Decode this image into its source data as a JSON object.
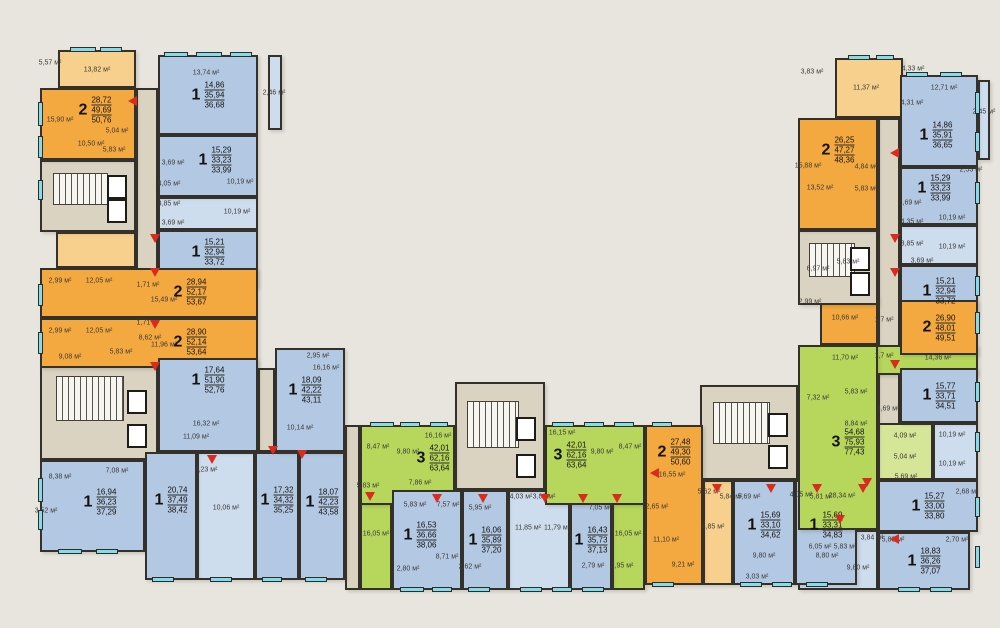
{
  "plan": {
    "width": 1000,
    "height": 628,
    "background": "#e8e5df",
    "palette": {
      "one_room": "#b3c8e2",
      "one_room_light": "#cdddee",
      "two_room": "#f3a93f",
      "two_room_light": "#f8d08d",
      "three_room": "#b6d75c",
      "three_room_light": "#d6e698",
      "common_area": "#dad3c1",
      "wall": "#34312b",
      "window": "#84dcea",
      "entrance_arrow": "#d92c1e"
    },
    "area_unit": "м²"
  },
  "apartments": [
    {
      "n": "2",
      "a": [
        "28,72",
        "49,69",
        "50,76"
      ],
      "c": "two",
      "r": [
        40,
        88,
        96,
        72
      ],
      "l": [
        95,
        110
      ]
    },
    {
      "n": "1",
      "a": [
        "14,86",
        "35,94",
        "36,68"
      ],
      "c": "one",
      "r": [
        158,
        55,
        100,
        80
      ],
      "l": [
        208,
        95
      ]
    },
    {
      "n": "1",
      "a": [
        "15,29",
        "33,23",
        "33,99"
      ],
      "c": "one",
      "r": [
        158,
        135,
        100,
        62
      ],
      "l": [
        215,
        160
      ]
    },
    {
      "n": "1",
      "a": [
        "15,21",
        "32,94",
        "33,72"
      ],
      "c": "one",
      "r": [
        158,
        230,
        100,
        58
      ],
      "l": [
        208,
        252
      ]
    },
    {
      "n": "2",
      "a": [
        "28,94",
        "52,17",
        "53,67"
      ],
      "c": "two",
      "r": [
        40,
        268,
        218,
        50
      ],
      "l": [
        190,
        292
      ]
    },
    {
      "n": "2",
      "a": [
        "28,90",
        "52,14",
        "53,64"
      ],
      "c": "two",
      "r": [
        40,
        318,
        218,
        50
      ],
      "l": [
        190,
        342
      ]
    },
    {
      "n": "1",
      "a": [
        "17,64",
        "51,90",
        "52,76"
      ],
      "c": "one",
      "r": [
        158,
        358,
        100,
        94
      ],
      "l": [
        208,
        380
      ]
    },
    {
      "n": "1",
      "a": [
        "16,94",
        "36,23",
        "37,29"
      ],
      "c": "one",
      "r": [
        40,
        460,
        105,
        92
      ],
      "l": [
        100,
        502
      ]
    },
    {
      "n": "1",
      "a": [
        "20,74",
        "37,49",
        "38,42"
      ],
      "c": "one",
      "r": [
        145,
        452,
        52,
        128
      ],
      "l": [
        171,
        500
      ]
    },
    {
      "n": "1",
      "a": [
        "17,32",
        "34,32",
        "35,25"
      ],
      "c": "one",
      "r": [
        255,
        452,
        44,
        128
      ],
      "l": [
        277,
        500
      ]
    },
    {
      "n": "1",
      "a": [
        "18,07",
        "42,23",
        "43,58"
      ],
      "c": "one",
      "r": [
        299,
        452,
        46,
        128
      ],
      "l": [
        322,
        502
      ]
    },
    {
      "n": "1",
      "a": [
        "18,09",
        "42,22",
        "43,11"
      ],
      "c": "one",
      "r": [
        275,
        348,
        70,
        104
      ],
      "l": [
        305,
        390
      ]
    },
    {
      "n": "3",
      "a": [
        "42,01",
        "62,16",
        "63,64"
      ],
      "c": "three",
      "r": [
        360,
        425,
        95,
        80
      ],
      "l": [
        433,
        458
      ]
    },
    {
      "n": "1",
      "a": [
        "16,53",
        "36,66",
        "38,06"
      ],
      "c": "one",
      "r": [
        392,
        490,
        70,
        100
      ],
      "l": [
        420,
        535
      ]
    },
    {
      "n": "1",
      "a": [
        "16,06",
        "35,89",
        "37,20"
      ],
      "c": "one",
      "r": [
        462,
        490,
        46,
        100
      ],
      "l": [
        485,
        540
      ]
    },
    {
      "n": "1",
      "a": [
        "16,43",
        "35,73",
        "37,13"
      ],
      "c": "one",
      "r": [
        570,
        490,
        42,
        100
      ],
      "l": [
        591,
        540
      ]
    },
    {
      "n": "3",
      "a": [
        "42,01",
        "62,16",
        "63,64"
      ],
      "c": "three",
      "r": [
        545,
        425,
        100,
        80
      ],
      "l": [
        570,
        455
      ]
    },
    {
      "n": "2",
      "a": [
        "27,48",
        "49,30",
        "50,60"
      ],
      "c": "two",
      "r": [
        645,
        425,
        58,
        160
      ],
      "l": [
        674,
        452
      ]
    },
    {
      "n": "1",
      "a": [
        "15,69",
        "33,10",
        "34,62"
      ],
      "c": "one",
      "r": [
        733,
        480,
        62,
        105
      ],
      "l": [
        764,
        525
      ]
    },
    {
      "n": "1",
      "a": [
        "15,69",
        "33,31",
        "34,83"
      ],
      "c": "one",
      "r": [
        795,
        480,
        62,
        105
      ],
      "l": [
        826,
        525
      ]
    },
    {
      "n": "2",
      "a": [
        "26,25",
        "47,27",
        "48,36"
      ],
      "c": "two",
      "r": [
        798,
        118,
        80,
        112
      ],
      "l": [
        838,
        150
      ]
    },
    {
      "n": "1",
      "a": [
        "14,86",
        "35,91",
        "36,65"
      ],
      "c": "one",
      "r": [
        900,
        75,
        78,
        92
      ],
      "l": [
        936,
        135
      ]
    },
    {
      "n": "1",
      "a": [
        "15,29",
        "33,23",
        "33,99"
      ],
      "c": "one",
      "r": [
        900,
        167,
        78,
        58
      ],
      "l": [
        934,
        188
      ]
    },
    {
      "n": "1",
      "a": [
        "15,21",
        "32,94",
        "33,72"
      ],
      "c": "one",
      "r": [
        900,
        265,
        78,
        52
      ]
    },
    {
      "n": "2",
      "a": [
        "26,90",
        "48,01",
        "49,51"
      ],
      "c": "two",
      "r": [
        900,
        300,
        78,
        55
      ]
    },
    {
      "n": "1",
      "a": [
        "15,77",
        "33,71",
        "34,51"
      ],
      "c": "one",
      "r": [
        900,
        368,
        78,
        55
      ]
    },
    {
      "n": "3",
      "a": [
        "54,68",
        "75,93",
        "77,43"
      ],
      "c": "three",
      "r": [
        798,
        345,
        80,
        185
      ],
      "l": [
        848,
        442
      ]
    },
    {
      "n": "1",
      "a": [
        "15,27",
        "33,00",
        "33,80"
      ],
      "c": "one",
      "r": [
        878,
        480,
        100,
        52
      ]
    },
    {
      "n": "1",
      "a": [
        "18,83",
        "36,26",
        "37,07"
      ],
      "c": "one",
      "r": [
        878,
        532,
        92,
        58
      ]
    }
  ],
  "zones": [
    {
      "c": "two_light",
      "r": [
        58,
        50,
        78,
        38
      ]
    },
    {
      "c": "two_light",
      "r": [
        56,
        232,
        80,
        36
      ]
    },
    {
      "c": "common",
      "r": [
        136,
        88,
        22,
        372
      ]
    },
    {
      "c": "one_light",
      "r": [
        158,
        197,
        100,
        33
      ]
    },
    {
      "c": "one_light",
      "r": [
        197,
        452,
        58,
        128
      ]
    },
    {
      "c": "common",
      "r": [
        345,
        425,
        15,
        165
      ]
    },
    {
      "c": "common",
      "r": [
        258,
        368,
        17,
        84
      ]
    },
    {
      "c": "three",
      "r": [
        360,
        500,
        32,
        90
      ]
    },
    {
      "c": "one_light",
      "r": [
        508,
        490,
        62,
        100
      ]
    },
    {
      "c": "three",
      "r": [
        612,
        500,
        33,
        90
      ]
    },
    {
      "c": "two_light",
      "r": [
        703,
        480,
        30,
        105
      ]
    },
    {
      "c": "one_light",
      "r": [
        857,
        480,
        21,
        105
      ]
    },
    {
      "c": "two_light",
      "r": [
        835,
        58,
        68,
        60
      ]
    },
    {
      "c": "common",
      "r": [
        878,
        118,
        22,
        362
      ]
    },
    {
      "c": "one_light",
      "r": [
        900,
        225,
        78,
        40
      ]
    },
    {
      "c": "two",
      "r": [
        820,
        295,
        58,
        50
      ]
    },
    {
      "c": "three",
      "r": [
        820,
        345,
        158,
        30
      ]
    },
    {
      "c": "three_light",
      "r": [
        878,
        423,
        55,
        57
      ]
    },
    {
      "c": "one_light",
      "r": [
        933,
        423,
        45,
        57
      ]
    },
    {
      "c": "one_light",
      "r": [
        798,
        530,
        80,
        60
      ]
    },
    {
      "c": "one_light",
      "r": [
        268,
        55,
        14,
        75
      ]
    },
    {
      "c": "one_light",
      "r": [
        978,
        80,
        12,
        80
      ]
    }
  ],
  "cores": [
    {
      "r": [
        40,
        160,
        96,
        72
      ]
    },
    {
      "r": [
        40,
        358,
        118,
        102
      ]
    },
    {
      "r": [
        455,
        382,
        90,
        108
      ]
    },
    {
      "r": [
        700,
        385,
        98,
        95
      ]
    },
    {
      "r": [
        798,
        230,
        80,
        75
      ]
    }
  ],
  "windows": [
    [
      70,
      47,
      26,
      5
    ],
    [
      100,
      47,
      22,
      5
    ],
    [
      164,
      52,
      24,
      5
    ],
    [
      196,
      52,
      26,
      5
    ],
    [
      230,
      52,
      22,
      5
    ],
    [
      848,
      55,
      22,
      5
    ],
    [
      876,
      55,
      18,
      5
    ],
    [
      906,
      72,
      22,
      5
    ],
    [
      940,
      72,
      22,
      5
    ],
    [
      38,
      102,
      5,
      24
    ],
    [
      38,
      136,
      5,
      22
    ],
    [
      38,
      180,
      5,
      20
    ],
    [
      38,
      284,
      5,
      22
    ],
    [
      38,
      332,
      5,
      22
    ],
    [
      38,
      478,
      5,
      24
    ],
    [
      38,
      510,
      5,
      20
    ],
    [
      975,
      92,
      5,
      22
    ],
    [
      975,
      132,
      5,
      20
    ],
    [
      975,
      182,
      5,
      22
    ],
    [
      975,
      276,
      5,
      20
    ],
    [
      975,
      312,
      5,
      22
    ],
    [
      975,
      382,
      5,
      20
    ],
    [
      975,
      432,
      5,
      20
    ],
    [
      975,
      497,
      5,
      20
    ],
    [
      975,
      546,
      5,
      22
    ],
    [
      58,
      549,
      24,
      5
    ],
    [
      96,
      549,
      22,
      5
    ],
    [
      152,
      577,
      22,
      5
    ],
    [
      210,
      577,
      22,
      5
    ],
    [
      262,
      577,
      20,
      5
    ],
    [
      305,
      577,
      22,
      5
    ],
    [
      400,
      587,
      24,
      5
    ],
    [
      432,
      587,
      20,
      5
    ],
    [
      468,
      587,
      22,
      5
    ],
    [
      520,
      587,
      22,
      5
    ],
    [
      552,
      587,
      20,
      5
    ],
    [
      582,
      587,
      22,
      5
    ],
    [
      652,
      582,
      22,
      5
    ],
    [
      740,
      582,
      22,
      5
    ],
    [
      772,
      582,
      20,
      5
    ],
    [
      806,
      582,
      22,
      5
    ],
    [
      898,
      587,
      22,
      5
    ],
    [
      930,
      587,
      22,
      5
    ],
    [
      370,
      422,
      24,
      5
    ],
    [
      400,
      422,
      20,
      5
    ],
    [
      430,
      422,
      18,
      5
    ],
    [
      552,
      422,
      22,
      5
    ],
    [
      584,
      422,
      20,
      5
    ],
    [
      614,
      422,
      20,
      5
    ],
    [
      652,
      422,
      20,
      5
    ]
  ],
  "arrows": [
    [
      128,
      96,
      "l"
    ],
    [
      150,
      234,
      "d"
    ],
    [
      150,
      268,
      "d"
    ],
    [
      150,
      320,
      "d"
    ],
    [
      150,
      362,
      "d"
    ],
    [
      207,
      455,
      "d"
    ],
    [
      268,
      446,
      "d"
    ],
    [
      297,
      450,
      "d"
    ],
    [
      365,
      492,
      "d"
    ],
    [
      432,
      494,
      "d"
    ],
    [
      478,
      494,
      "d"
    ],
    [
      540,
      494,
      "d"
    ],
    [
      578,
      494,
      "d"
    ],
    [
      612,
      494,
      "d"
    ],
    [
      650,
      468,
      "l"
    ],
    [
      712,
      484,
      "d"
    ],
    [
      766,
      484,
      "d"
    ],
    [
      812,
      484,
      "d"
    ],
    [
      858,
      484,
      "d"
    ],
    [
      890,
      148,
      "l"
    ],
    [
      890,
      234,
      "d"
    ],
    [
      890,
      268,
      "d"
    ],
    [
      890,
      360,
      "d"
    ],
    [
      862,
      478,
      "d"
    ],
    [
      835,
      515,
      "d"
    ],
    [
      890,
      534,
      "l"
    ]
  ],
  "rooms": [
    [
      "5,57 м²",
      50,
      63
    ],
    [
      "13,82 м²",
      97,
      70
    ],
    [
      "13,74 м²",
      206,
      73
    ],
    [
      "2,46 м²",
      274,
      93
    ],
    [
      "15,90 м²",
      60,
      120
    ],
    [
      "10,50 м²",
      91,
      144
    ],
    [
      "5,04 м²",
      117,
      131
    ],
    [
      "5,83 м²",
      114,
      150
    ],
    [
      "3,69 м²",
      173,
      163
    ],
    [
      "4,05 м²",
      169,
      184
    ],
    [
      "3,85 м²",
      169,
      204
    ],
    [
      "10,19 м²",
      240,
      182
    ],
    [
      "10,19 м²",
      237,
      212
    ],
    [
      "3,69 м²",
      173,
      223
    ],
    [
      "2,99 м²",
      60,
      281
    ],
    [
      "12,05 м²",
      99,
      281
    ],
    [
      "1,71 м²",
      148,
      285
    ],
    [
      "15,49 м²",
      164,
      300
    ],
    [
      "2,99 м²",
      60,
      331
    ],
    [
      "12,05 м²",
      99,
      331
    ],
    [
      "1,71 м²",
      148,
      323
    ],
    [
      "11,96 м²",
      164,
      345
    ],
    [
      "9,08 м²",
      70,
      357
    ],
    [
      "5,83 м²",
      121,
      352
    ],
    [
      "8,62 м²",
      150,
      338
    ],
    [
      "16,32 м²",
      206,
      424
    ],
    [
      "11,09 м²",
      196,
      437
    ],
    [
      "8,38 м²",
      60,
      477
    ],
    [
      "7,08 м²",
      117,
      471
    ],
    [
      "3,52 м²",
      46,
      511
    ],
    [
      "10,06 м²",
      226,
      508
    ],
    [
      "3,23 м²",
      206,
      470
    ],
    [
      "2,95 м²",
      318,
      356
    ],
    [
      "16,16 м²",
      326,
      368
    ],
    [
      "10,14 м²",
      300,
      428
    ],
    [
      "16,16 м²",
      438,
      436
    ],
    [
      "8,47 м²",
      378,
      447
    ],
    [
      "9,80 м²",
      408,
      452
    ],
    [
      "5,83 м²",
      368,
      486
    ],
    [
      "7,86 м²",
      420,
      483
    ],
    [
      "16,05 м²",
      376,
      534
    ],
    [
      "5,83 м²",
      415,
      505
    ],
    [
      "7,57 м²",
      448,
      505
    ],
    [
      "8,71 м²",
      447,
      557
    ],
    [
      "2,80 м²",
      408,
      569
    ],
    [
      "5,95 м²",
      480,
      508
    ],
    [
      "4,03 м²",
      521,
      497
    ],
    [
      "3,83 м²",
      544,
      497
    ],
    [
      "11,85 м²",
      528,
      528
    ],
    [
      "11,79 м²",
      557,
      528
    ],
    [
      "2,62 м²",
      470,
      567
    ],
    [
      "16,15 м²",
      562,
      433
    ],
    [
      "9,80 м²",
      602,
      452
    ],
    [
      "8,47 м²",
      630,
      447
    ],
    [
      "7,05 м²",
      600,
      508
    ],
    [
      "16,05 м²",
      628,
      534
    ],
    [
      "2,79 м²",
      593,
      566
    ],
    [
      "2,95 м²",
      622,
      566
    ],
    [
      "16,55 м²",
      672,
      475
    ],
    [
      "2,65 м²",
      657,
      507
    ],
    [
      "11,10 м²",
      666,
      540
    ],
    [
      "9,21 м²",
      683,
      565
    ],
    [
      "5,62 м²",
      709,
      492
    ],
    [
      "4,85 м²",
      713,
      527
    ],
    [
      "5,84 м²",
      731,
      497
    ],
    [
      "5,69 м²",
      749,
      497
    ],
    [
      "9,80 м²",
      764,
      556
    ],
    [
      "3,03 м²",
      757,
      577
    ],
    [
      "4,05 м²",
      801,
      495
    ],
    [
      "5,81 м²",
      821,
      497
    ],
    [
      "8,80 м²",
      827,
      556
    ],
    [
      "3,83 м²",
      812,
      72
    ],
    [
      "11,37 м²",
      866,
      88
    ],
    [
      "4,33 м²",
      913,
      69
    ],
    [
      "12,71 м²",
      944,
      88
    ],
    [
      "4,31 м²",
      912,
      103
    ],
    [
      "2,45 м²",
      984,
      112
    ],
    [
      "15,88 м²",
      808,
      166
    ],
    [
      "4,84 м²",
      866,
      167
    ],
    [
      "13,52 м²",
      820,
      188
    ],
    [
      "5,83 м²",
      866,
      189
    ],
    [
      "2,53 м²",
      971,
      170
    ],
    [
      "3,69 м²",
      910,
      203
    ],
    [
      "4,35 м²",
      912,
      222
    ],
    [
      "10,19 м²",
      952,
      218
    ],
    [
      "3,85 м²",
      912,
      244
    ],
    [
      "10,19 м²",
      952,
      247
    ],
    [
      "3,69 м²",
      922,
      261
    ],
    [
      "6,97 м²",
      818,
      269
    ],
    [
      "5,83 м²",
      848,
      262
    ],
    [
      "2,99 м²",
      810,
      302
    ],
    [
      "10,66 м²",
      845,
      318
    ],
    [
      "1,7 м²",
      884,
      320
    ],
    [
      "11,70 м²",
      845,
      358
    ],
    [
      "1,7 м²",
      884,
      356
    ],
    [
      "14,36 м²",
      938,
      358
    ],
    [
      "7,32 м²",
      818,
      398
    ],
    [
      "5,83 м²",
      856,
      392
    ],
    [
      "8,84 м²",
      856,
      424
    ],
    [
      "3,69 м²",
      888,
      409
    ],
    [
      "4,09 м²",
      905,
      436
    ],
    [
      "10,19 м²",
      952,
      435
    ],
    [
      "5,04 м²",
      905,
      457
    ],
    [
      "10,19 м²",
      952,
      464
    ],
    [
      "5,69 м²",
      906,
      477
    ],
    [
      "28,34 м²",
      842,
      496
    ],
    [
      "2,68 м²",
      967,
      492
    ],
    [
      "3,84 м²",
      872,
      538
    ],
    [
      "5,83 м²",
      893,
      540
    ],
    [
      "2,70 м²",
      957,
      540
    ],
    [
      "6,05 м²",
      820,
      547
    ],
    [
      "5,83 м²",
      845,
      547
    ],
    [
      "9,80 м²",
      858,
      568
    ]
  ]
}
